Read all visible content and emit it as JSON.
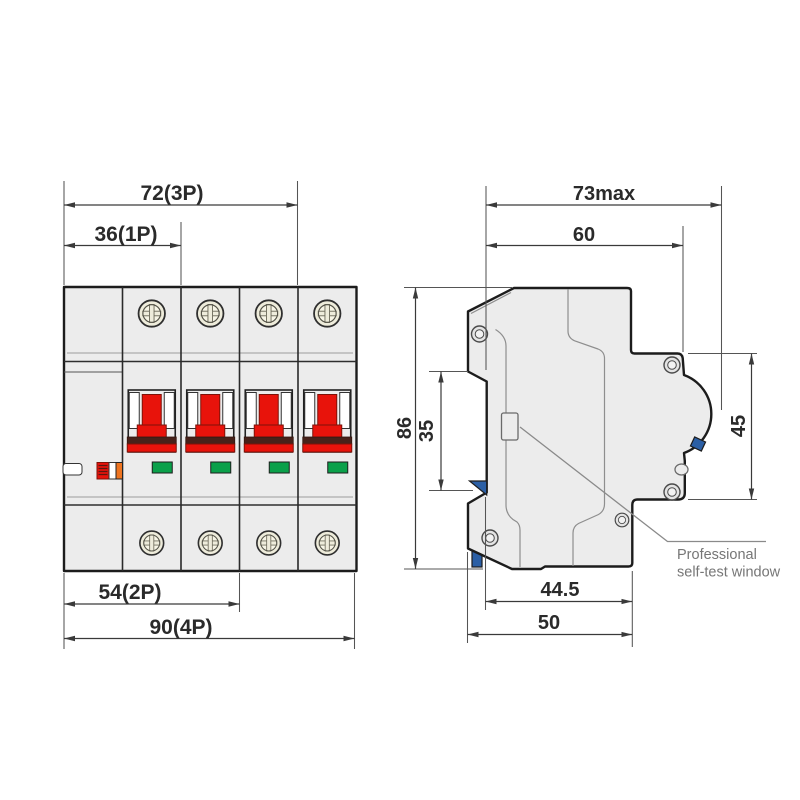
{
  "drawing": {
    "type": "circuit-breaker dimensional drawing",
    "front_view": {
      "dims": {
        "d72": "72(3P)",
        "d36": "36(1P)",
        "d54": "54(2P)",
        "d90": "90(4P)"
      },
      "poles": 4
    },
    "side_view": {
      "dims": {
        "d73": "73max",
        "d60": "60",
        "d86": "86",
        "d35": "35",
        "d45": "45",
        "d44_5": "44.5",
        "d50": "50"
      },
      "annotation": {
        "line1": "Professional",
        "line2": "self-test window"
      }
    },
    "colors": {
      "body_fill": "#ececec",
      "outline": "#1c1c1c",
      "handle_red": "#e8130b",
      "stripe_dark_red": "#47221a",
      "indicator_green": "#0aa04a",
      "test_button_orange": "#ee7420",
      "din_clip_blue": "#2b5fa5",
      "screw_beige": "#eeecdb",
      "dimension_text": "#2a2a2a",
      "annotation_gray": "#767676"
    }
  }
}
